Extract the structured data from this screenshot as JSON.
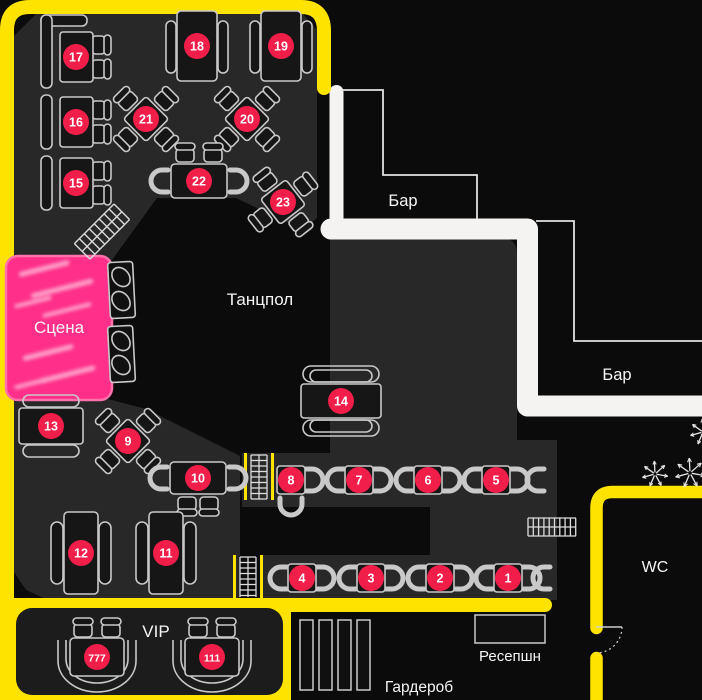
{
  "colors": {
    "yellow": "#ffe300",
    "stage_pink": "#ff2f8a",
    "stage_border": "#ff71ab",
    "badge_red": "#f01e49",
    "walkway_white": "#f4f3f1",
    "area_gray": "#282828",
    "line_gray": "#c9c9c9",
    "table_fill": "#161616",
    "label_white": "#f5f5f5"
  },
  "labels": {
    "stage": "Сцена",
    "dancefloor": "Танцпол",
    "bar_top": "Бар",
    "bar_right": "Бар",
    "wc": "WC",
    "vip": "VIP",
    "reception": "Ресепшн",
    "cloakroom": "Гардероб"
  },
  "tables": [
    {
      "id": "1",
      "x": 508,
      "y": 578,
      "type": "row"
    },
    {
      "id": "2",
      "x": 440,
      "y": 578,
      "type": "row"
    },
    {
      "id": "3",
      "x": 371,
      "y": 578,
      "type": "row"
    },
    {
      "id": "4",
      "x": 302,
      "y": 578,
      "type": "row"
    },
    {
      "id": "5",
      "x": 496,
      "y": 480,
      "type": "row"
    },
    {
      "id": "6",
      "x": 428,
      "y": 480,
      "type": "row"
    },
    {
      "id": "7",
      "x": 359,
      "y": 480,
      "type": "row"
    },
    {
      "id": "8",
      "x": 291,
      "y": 480,
      "type": "row8"
    },
    {
      "id": "9",
      "x": 128,
      "y": 441,
      "type": "diamond",
      "rot": 45
    },
    {
      "id": "10",
      "x": 198,
      "y": 478,
      "type": "h10"
    },
    {
      "id": "11",
      "x": 166,
      "y": 553,
      "type": "vert2"
    },
    {
      "id": "12",
      "x": 81,
      "y": 553,
      "type": "vert2"
    },
    {
      "id": "13",
      "x": 51,
      "y": 426,
      "type": "hbench"
    },
    {
      "id": "14",
      "x": 341,
      "y": 401,
      "type": "hbench2"
    },
    {
      "id": "15",
      "x": 76,
      "y": 183,
      "type": "booth"
    },
    {
      "id": "16",
      "x": 76,
      "y": 122,
      "type": "booth"
    },
    {
      "id": "17",
      "x": 76,
      "y": 57,
      "type": "boothL"
    },
    {
      "id": "18",
      "x": 197,
      "y": 46,
      "type": "vert"
    },
    {
      "id": "19",
      "x": 281,
      "y": 46,
      "type": "vert"
    },
    {
      "id": "20",
      "x": 247,
      "y": 119,
      "type": "diamond",
      "rot": 45
    },
    {
      "id": "21",
      "x": 146,
      "y": 119,
      "type": "diamond",
      "rot": 45
    },
    {
      "id": "22",
      "x": 199,
      "y": 181,
      "type": "h4"
    },
    {
      "id": "23",
      "x": 283,
      "y": 202,
      "type": "diamond",
      "rot": -38
    },
    {
      "id": "777",
      "x": 97,
      "y": 657,
      "type": "vip"
    },
    {
      "id": "111",
      "x": 212,
      "y": 657,
      "type": "vip"
    }
  ]
}
